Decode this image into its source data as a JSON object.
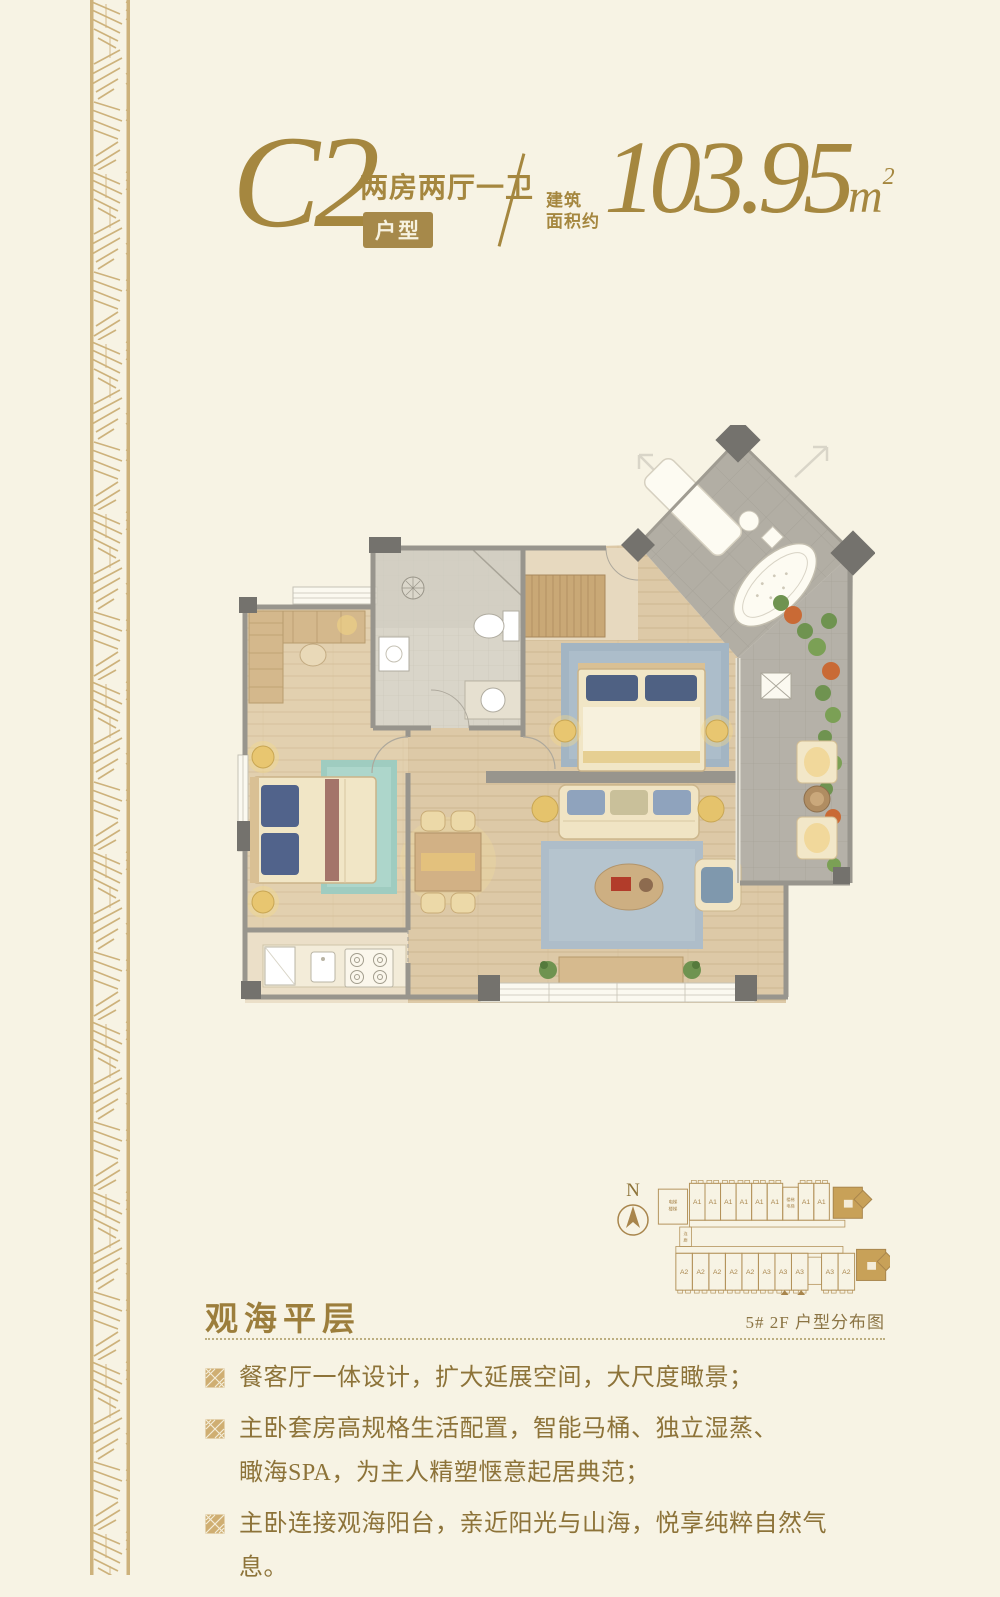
{
  "page": {
    "bg": "#f7f3e4",
    "accent_gold": "#a5873f",
    "badge_bg": "#a6894a",
    "diagram_highlight": "#c8a158"
  },
  "header": {
    "plan_code": "C2",
    "layout_type": "两房两厅一卫",
    "badge": "户型",
    "area_label_line1": "建筑",
    "area_label_line2": "面积约",
    "area_value": "103.95",
    "area_unit": "m",
    "area_exponent": "2"
  },
  "diagram": {
    "north_label": "N",
    "caption": "5#  2F 户型分布图",
    "elevator_lines": [
      "电梯",
      "楼梯"
    ],
    "stair_lines": [
      "楼梯",
      "电梯"
    ],
    "corridor_label": "连廊",
    "top_units": [
      "A1",
      "A1",
      "A1",
      "A1",
      "A1",
      "A1",
      "A1",
      "A1"
    ],
    "bottom_units": [
      "A2",
      "A2",
      "A2",
      "A2",
      "A2",
      "A3",
      "A3",
      "A3",
      "A3",
      "A2"
    ]
  },
  "section": {
    "title": "观海平层"
  },
  "bullets": [
    {
      "lines": [
        "餐客厅一体设计，扩大延展空间，大尺度瞰景；"
      ]
    },
    {
      "lines": [
        "主卧套房高规格生活配置，智能马桶、独立湿蒸、",
        "瞰海SPA，为主人精塑惬意起居典范；"
      ]
    },
    {
      "lines": [
        "主卧连接观海阳台，亲近阳光与山海，悦享纯粹自然气息。"
      ]
    }
  ]
}
